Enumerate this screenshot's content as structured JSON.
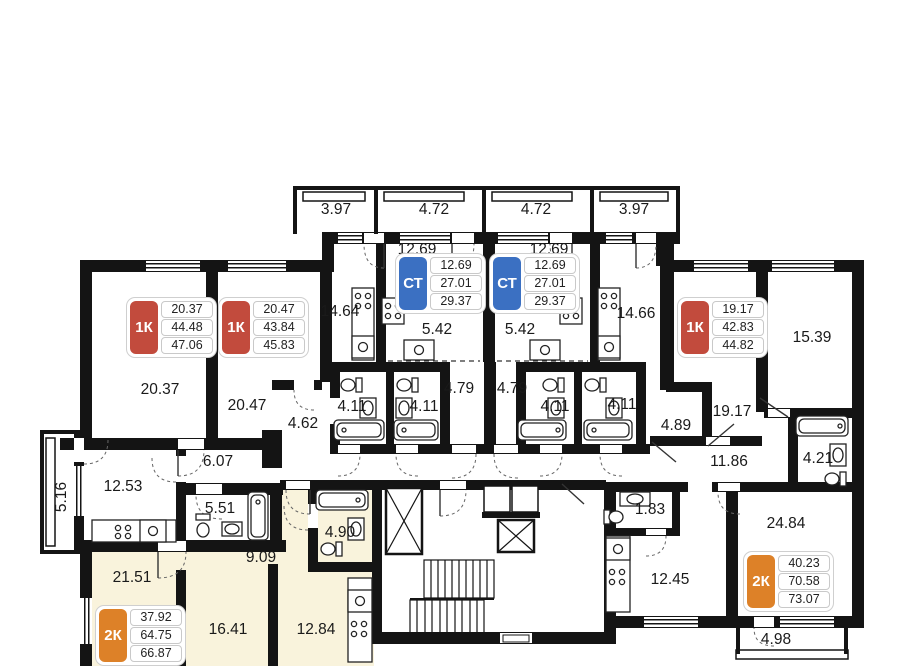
{
  "floorplan": {
    "colors": {
      "wall": "#141414",
      "highlight": "#f9f3dc",
      "label": "#1a1a1a",
      "badge_1k": "#c24b3d",
      "badge_ct": "#3b70c2",
      "badge_2k": "#dd8128"
    },
    "badges": [
      {
        "type": "1К",
        "color": "#c24b3d",
        "values": [
          "20.37",
          "44.48",
          "47.06"
        ]
      },
      {
        "type": "1К",
        "color": "#c24b3d",
        "values": [
          "20.47",
          "43.84",
          "45.83"
        ]
      },
      {
        "type": "СТ",
        "color": "#3b70c2",
        "values": [
          "12.69",
          "27.01",
          "29.37"
        ]
      },
      {
        "type": "СТ",
        "color": "#3b70c2",
        "values": [
          "12.69",
          "27.01",
          "29.37"
        ]
      },
      {
        "type": "1К",
        "color": "#c24b3d",
        "values": [
          "19.17",
          "42.83",
          "44.82"
        ]
      },
      {
        "type": "2К",
        "color": "#dd8128",
        "values": [
          "37.92",
          "64.75",
          "66.87"
        ]
      },
      {
        "type": "2К",
        "color": "#dd8128",
        "values": [
          "40.23",
          "70.58",
          "73.07"
        ]
      }
    ],
    "room_labels": [
      {
        "text": "3.97",
        "x": 336,
        "y": 210
      },
      {
        "text": "4.72",
        "x": 434,
        "y": 210
      },
      {
        "text": "4.72",
        "x": 536,
        "y": 210
      },
      {
        "text": "3.97",
        "x": 634,
        "y": 210
      },
      {
        "text": "12.69",
        "x": 417,
        "y": 250
      },
      {
        "text": "12.69",
        "x": 549,
        "y": 250
      },
      {
        "text": "14.64",
        "x": 340,
        "y": 312
      },
      {
        "text": "14.66",
        "x": 636,
        "y": 314
      },
      {
        "text": "20.37",
        "x": 160,
        "y": 390
      },
      {
        "text": "20.47",
        "x": 247,
        "y": 406
      },
      {
        "text": "5.42",
        "x": 437,
        "y": 330
      },
      {
        "text": "5.42",
        "x": 520,
        "y": 330
      },
      {
        "text": "15.39",
        "x": 812,
        "y": 338
      },
      {
        "text": "19.17",
        "x": 732,
        "y": 412
      },
      {
        "text": "4.11",
        "x": 352,
        "y": 407
      },
      {
        "text": "4.11",
        "x": 424,
        "y": 407
      },
      {
        "text": "4.79",
        "x": 459,
        "y": 389
      },
      {
        "text": "4.79",
        "x": 512,
        "y": 389
      },
      {
        "text": "4.11",
        "x": 555,
        "y": 407
      },
      {
        "text": "4.11",
        "x": 622,
        "y": 405
      },
      {
        "text": "4.89",
        "x": 676,
        "y": 426
      },
      {
        "text": "4.62",
        "x": 303,
        "y": 424
      },
      {
        "text": "11.86",
        "x": 729,
        "y": 462
      },
      {
        "text": "6.07",
        "x": 218,
        "y": 462
      },
      {
        "text": "12.53",
        "x": 123,
        "y": 487
      },
      {
        "text": "5.16",
        "x": 62,
        "y": 497,
        "rot": true
      },
      {
        "text": "5.51",
        "x": 220,
        "y": 509
      },
      {
        "text": "4.21",
        "x": 818,
        "y": 459
      },
      {
        "text": "1.83",
        "x": 650,
        "y": 510
      },
      {
        "text": "9.09",
        "x": 261,
        "y": 558
      },
      {
        "text": "21.51",
        "x": 132,
        "y": 578
      },
      {
        "text": "24.84",
        "x": 786,
        "y": 524
      },
      {
        "text": "12.45",
        "x": 670,
        "y": 580
      },
      {
        "text": "4.90",
        "x": 340,
        "y": 533
      },
      {
        "text": "16.41",
        "x": 228,
        "y": 630
      },
      {
        "text": "12.84",
        "x": 316,
        "y": 630
      },
      {
        "text": "4.98",
        "x": 776,
        "y": 640
      }
    ]
  }
}
